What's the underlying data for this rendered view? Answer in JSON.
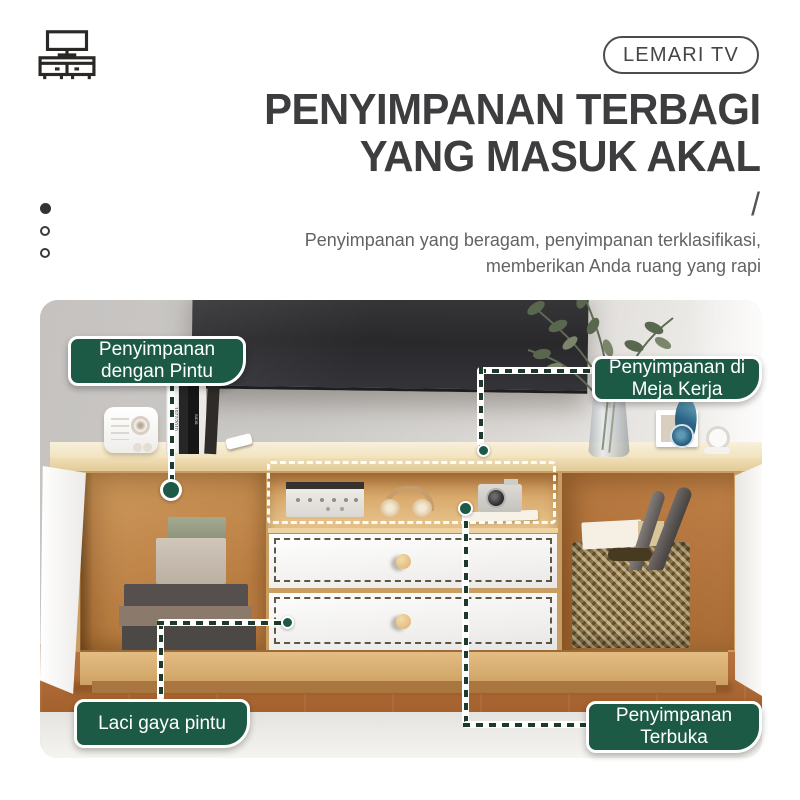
{
  "header": {
    "icon": "tv-cabinet-icon",
    "badge_label": "LEMARI TV",
    "title_line1": "PENYIMPANAN TERBAGI",
    "title_line2": "YANG MASUK AKAL",
    "slash": "/",
    "subtitle_line1": "Penyimpanan yang beragam, penyimpanan terklasifikasi,",
    "subtitle_line2": "memberikan Anda ruang yang rapi"
  },
  "callouts": {
    "door_storage": {
      "line1": "Penyimpanan",
      "line2": "dengan Pintu"
    },
    "desk_storage": {
      "line1": "Penyimpanan di",
      "line2": "Meja Kerja"
    },
    "drawer_storage": {
      "line1": "Laci gaya pintu"
    },
    "open_storage": {
      "line1": "Penyimpanan",
      "line2": "Terbuka"
    }
  },
  "photo": {
    "book_spine_1": "1977/2010",
    "book_spine_2": "SICIS"
  },
  "colors": {
    "accent_green": "#1d5a45",
    "leader_line": "#1d3a2c",
    "title_text": "#3d3d3f",
    "subtitle_text": "#636363",
    "badge_border": "#4c4c4c",
    "desk_wood": "#f2e3bd",
    "interior_wood": "#c5854a",
    "floor_wood": "#a96532"
  }
}
